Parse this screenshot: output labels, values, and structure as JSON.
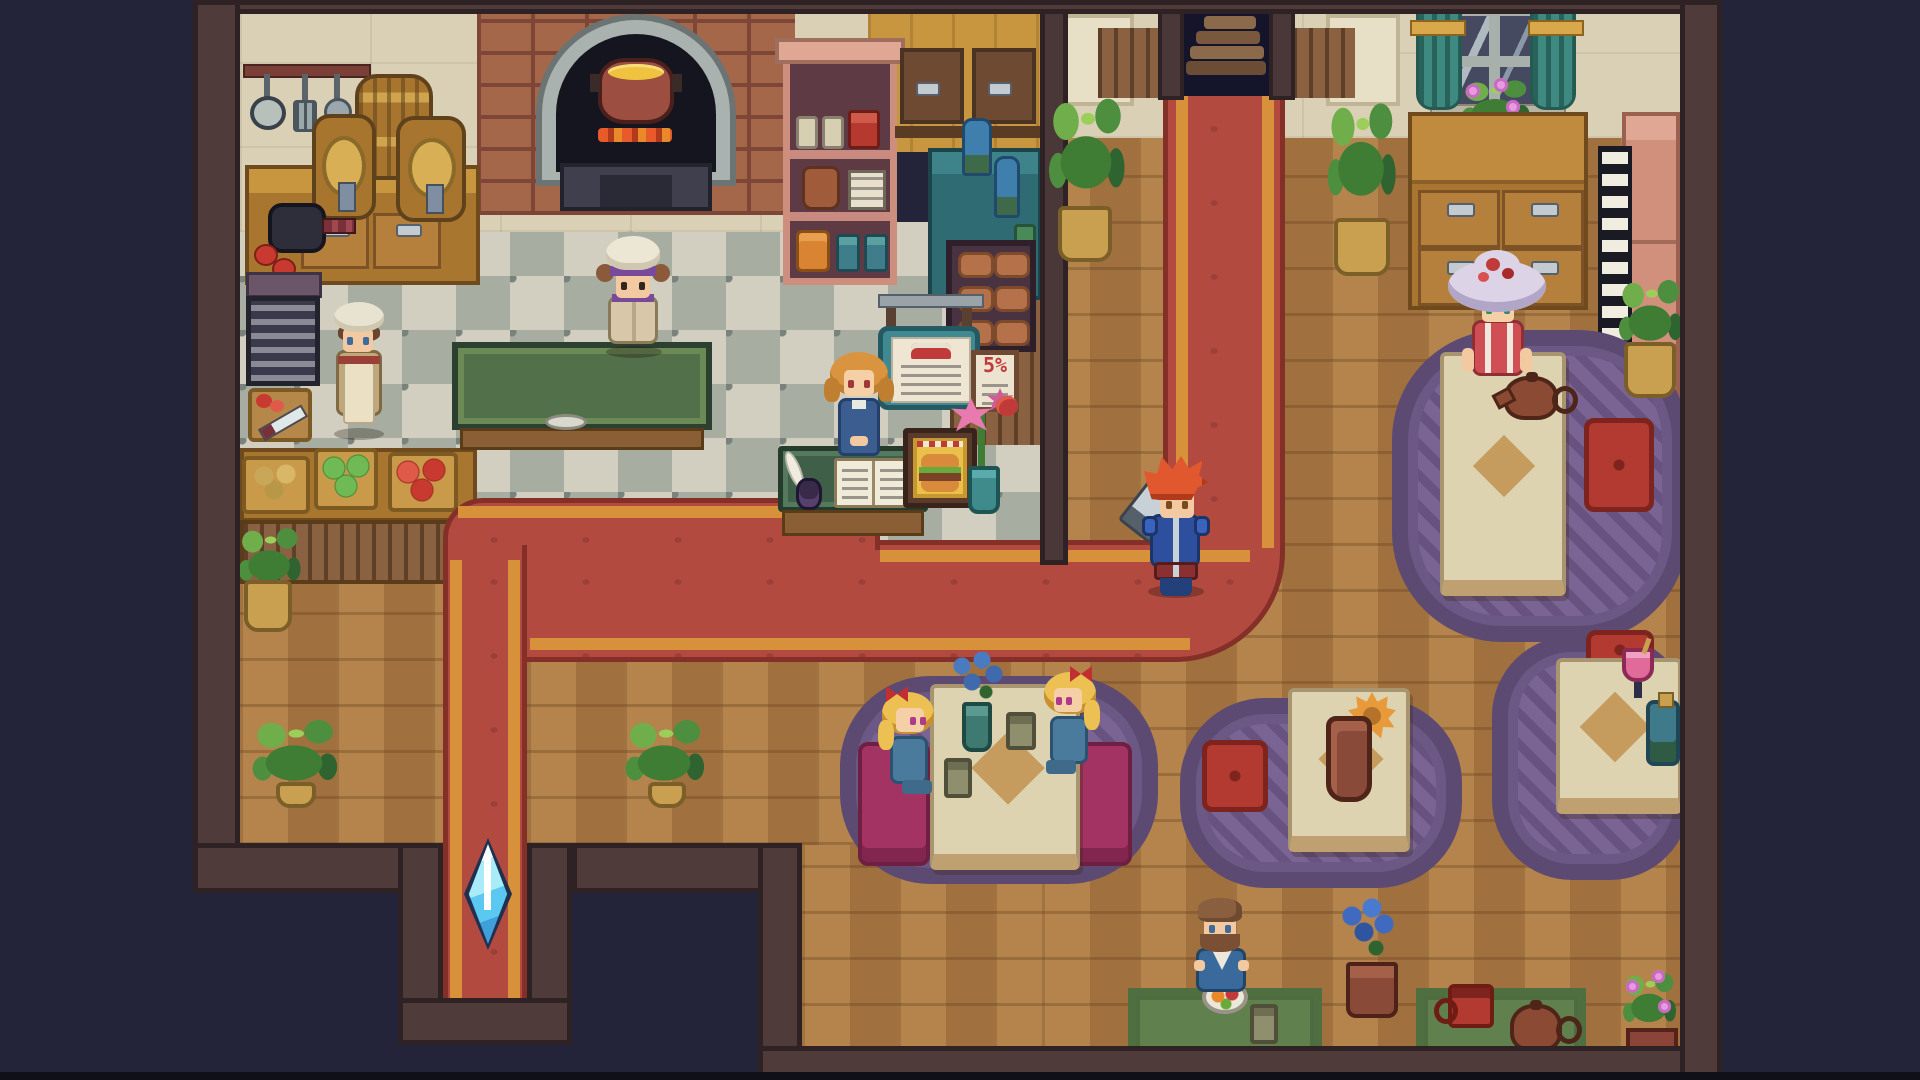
{
  "scene": {
    "description": "top-down pixel-art restaurant interior with kitchen, counter, dining tables and red carpet path",
    "signs": {
      "discount_poster": "5%"
    }
  },
  "palette": {
    "void": "#23233a",
    "wall_border": "#4f3b39",
    "kitchen_wall": "#d9d0b6",
    "wood_wall": "#c8963f",
    "checker_light": "#d2cec0",
    "checker_dark": "#a7aea1",
    "parquet": "#aa7943",
    "carpet_red": "#b24a40",
    "carpet_stripe": "#d6913a",
    "carpet_edge": "#842f28",
    "rug_purple": "#7a6494",
    "table_cream": "#ded3b1",
    "bench_magenta": "#a23362",
    "cushion_red": "#b23a30",
    "counter_teal": "#2f6b72",
    "shelf_pink": "#ce8e7e",
    "brick": "#a5674a",
    "stone_arch": "#a9b2ae",
    "soup": "#efc23f",
    "plant_green": "#4e8f3f",
    "pot_tan": "#c8a050",
    "crystal_blue": "#5ac8f0",
    "curtain_teal": "#3f8a80",
    "mat_green": "#60804d",
    "prep_table_green": "#52704a"
  },
  "characters": {
    "head_chef": {
      "label": "head chef at prep table",
      "hat": "white toque with purple band",
      "outfit": "tan chef coat"
    },
    "sous_chef": {
      "label": "kitchen assistant",
      "hat": "cream head wrap",
      "outfit": "tan dress with cream apron"
    },
    "hostess": {
      "label": "hostess at reception counter",
      "hair": "orange bob",
      "outfit": "blue dress"
    },
    "hero": {
      "label": "red-haired adventurer",
      "hair": "spiky red",
      "outfit": "blue armor with sword"
    },
    "flower_hat_lady": {
      "label": "lady in flower hat at tea table",
      "hat": "lavender hat with red flowers",
      "outfit": "red and white dress"
    },
    "twin_girl_left": {
      "label": "blonde girl with red bow",
      "outfit": "blue dress"
    },
    "twin_girl_right": {
      "label": "blonde girl with red bow",
      "outfit": "blue dress"
    },
    "bearded_diner": {
      "label": "bearded man eating at low table",
      "outfit": "blue jacket"
    }
  },
  "props": [
    "hanging utensils",
    "tapped barrels",
    "stone oven with soup pot",
    "ingredient baskets",
    "cutting board",
    "menu book",
    "quill and ink",
    "burger display sign",
    "hanging dessert menu sign",
    "discount poster",
    "lily vase",
    "save crystal",
    "tea pot and cup",
    "wine glass",
    "teal bottle",
    "flower vases",
    "potted plants",
    "bread shelf",
    "stairway exit"
  ]
}
